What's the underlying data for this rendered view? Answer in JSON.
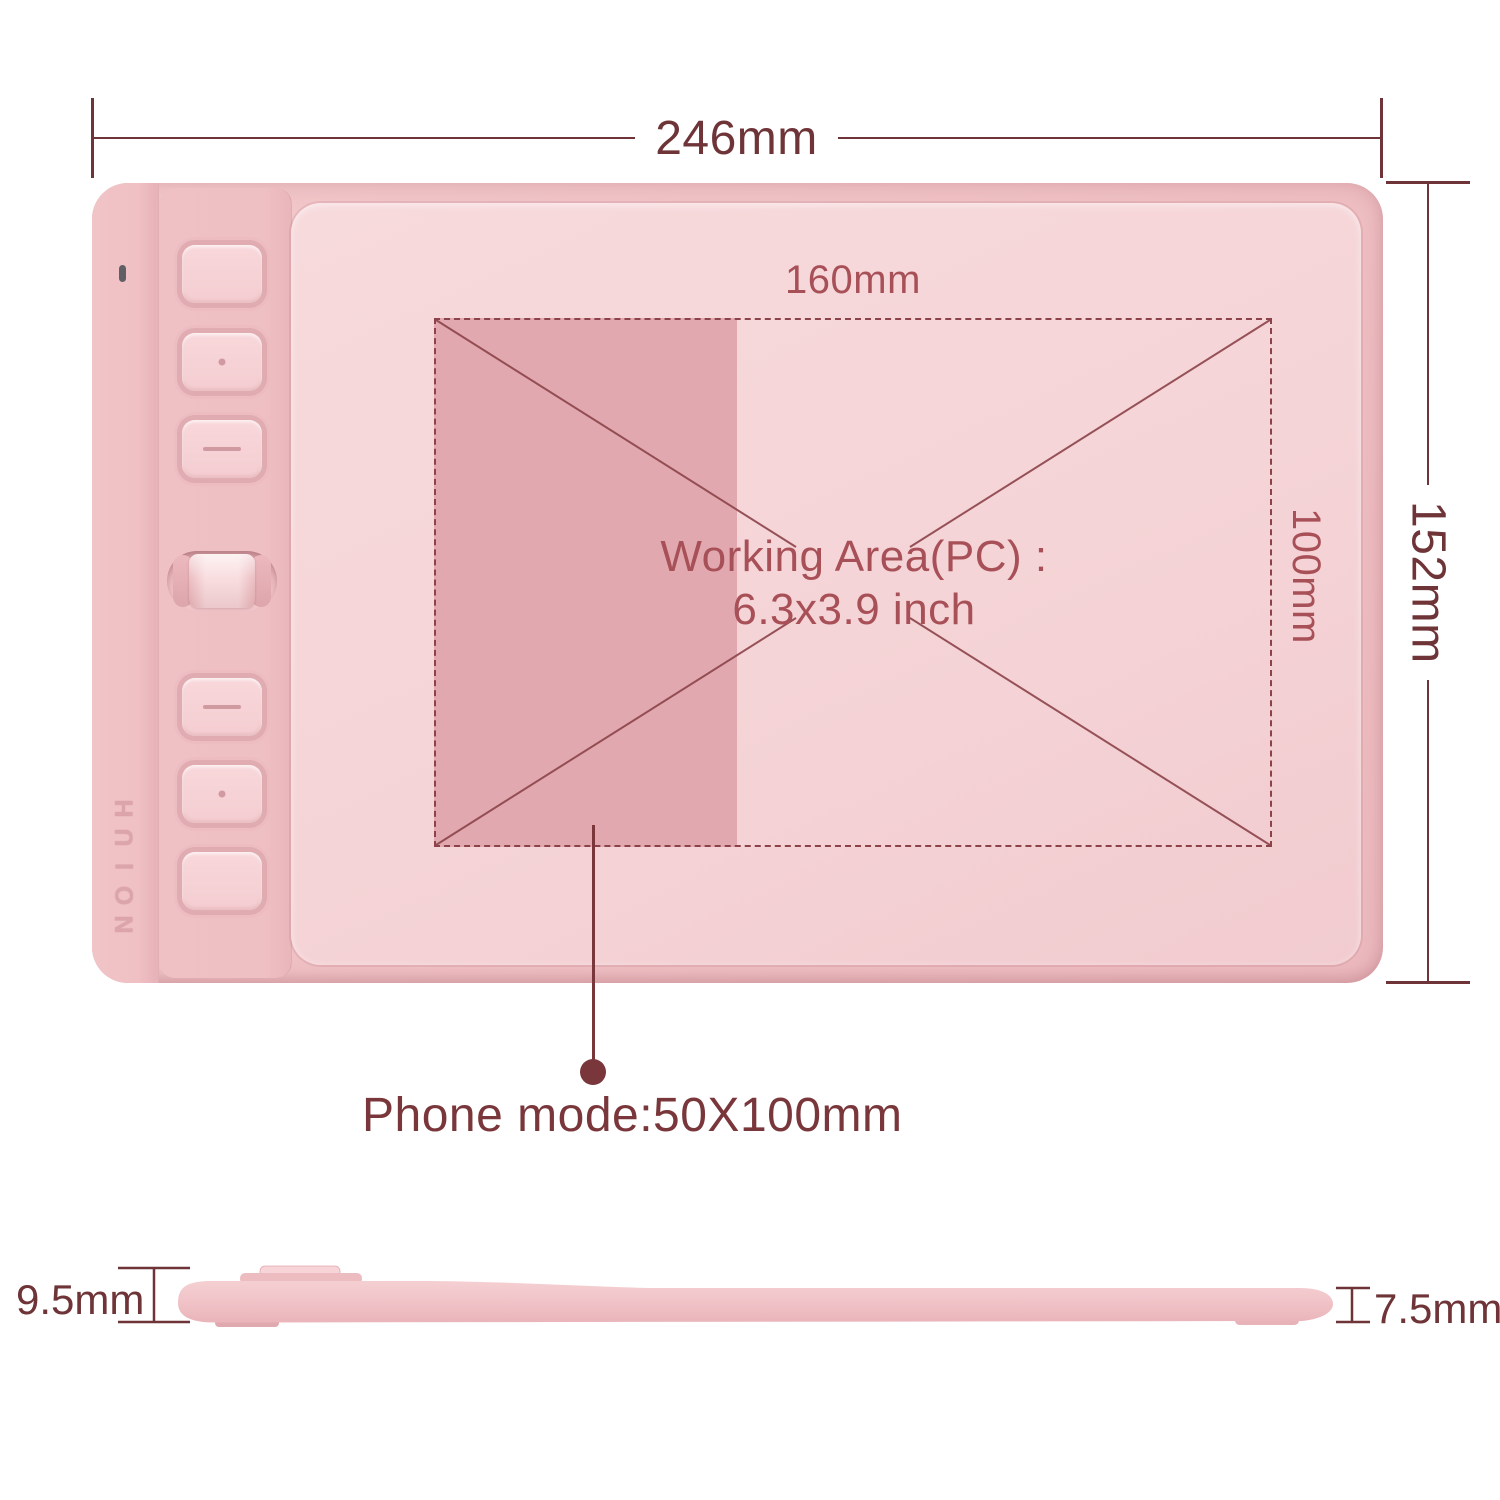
{
  "front_view": {
    "width_dim": {
      "label": "246mm"
    },
    "height_dim": {
      "label": "152mm"
    },
    "brand": "HUION",
    "express_keys": [
      {
        "glyph": "blank"
      },
      {
        "glyph": "dot"
      },
      {
        "glyph": "dash"
      },
      {
        "glyph": "dash"
      },
      {
        "glyph": "dot"
      },
      {
        "glyph": "blank"
      }
    ],
    "scroll_roller": "roller",
    "working_area": {
      "width_label": "160mm",
      "height_label": "100mm",
      "caption_line1": "Working Area(PC) :",
      "caption_line2": "6.3x3.9 inch"
    },
    "phone_mode": {
      "label": "Phone mode:50X100mm"
    }
  },
  "side_view": {
    "left_dim": {
      "label": "9.5mm"
    },
    "right_dim": {
      "label": "7.5mm"
    }
  },
  "colors": {
    "page_bg": "#ffffff",
    "dim_dark": "#6e3438",
    "annotation_dark": "#7a373b",
    "label_red": "#a85057",
    "dash_line": "#8b4349",
    "body_pink": "#f0c2c6",
    "strip_pink": "#edbec2",
    "surface_pink": "#f5d4d7",
    "phone_region_pink": "#e1a9af",
    "button_pink": "#f6d2d6",
    "led_gray": "#5f6065"
  }
}
